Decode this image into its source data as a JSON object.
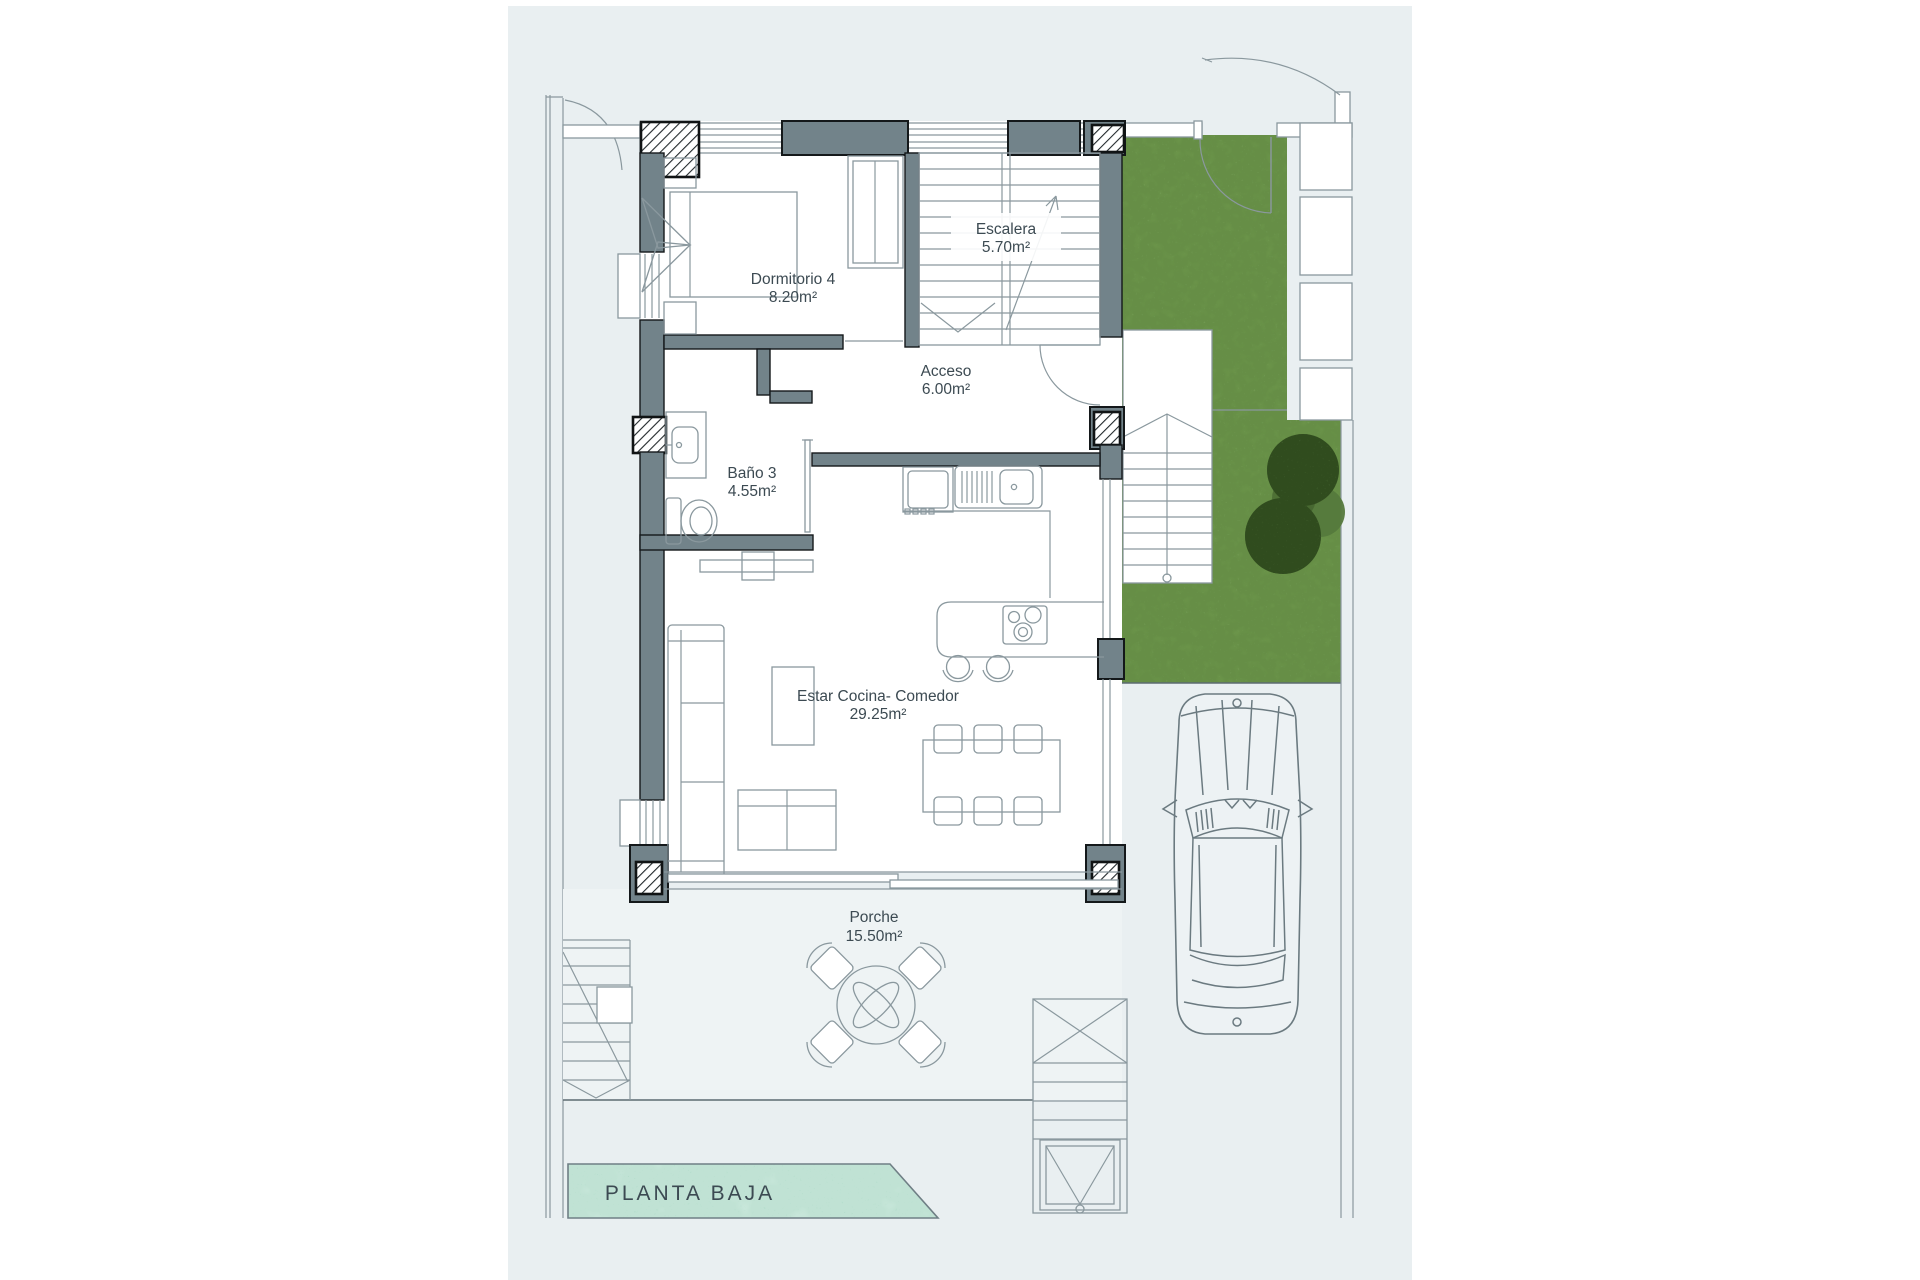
{
  "plan": {
    "floor_label": "PLANTA BAJA",
    "rooms": [
      {
        "name": "Dormitorio 4",
        "area": "8.20m²"
      },
      {
        "name": "Escalera",
        "area": "5.70m²"
      },
      {
        "name": "Acceso",
        "area": "6.00m²"
      },
      {
        "name": "Baño 3",
        "area": "4.55m²"
      },
      {
        "name": "Estar Cocina- Comedor",
        "area": "29.25m²"
      },
      {
        "name": "Porche",
        "area": "15.50m²"
      }
    ]
  },
  "colors": {
    "sheet": "#e9eff1",
    "wall": "#72838a",
    "line": "#8a989e",
    "text": "#3c4a52",
    "grass": "#a3c97f",
    "grass_dark": "#6f9a4e",
    "tree": "#4e7037",
    "pool": "#c8ebdd",
    "pool_dark": "#9ed3bd"
  }
}
